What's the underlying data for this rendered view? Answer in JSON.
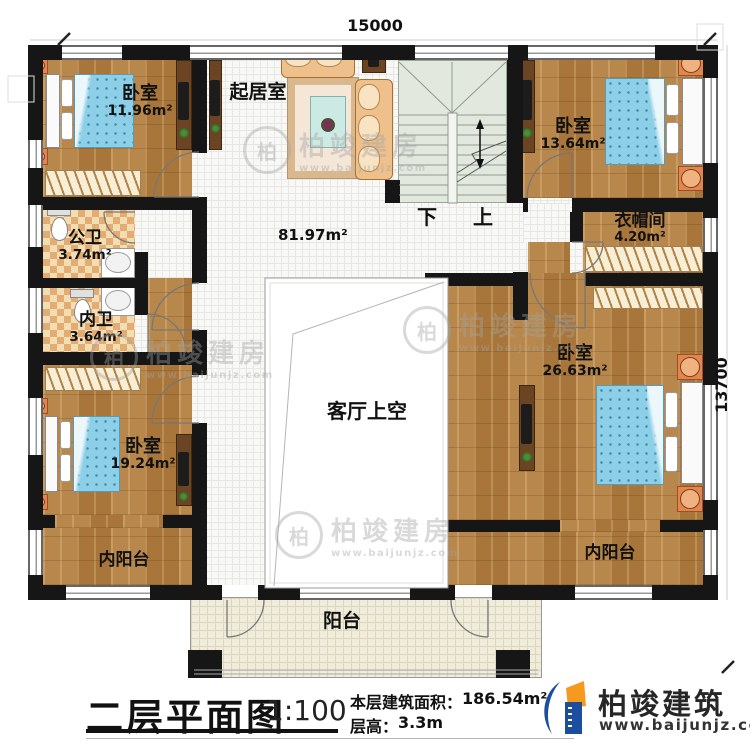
{
  "dimensions": {
    "top": "15000",
    "right": "13700"
  },
  "stairs": {
    "down": "下",
    "up": "上"
  },
  "rooms": {
    "bedroom_tl": {
      "name": "卧室",
      "area": "11.96m²"
    },
    "living": {
      "name": "起居室",
      "area": "81.97m²"
    },
    "bedroom_tr": {
      "name": "卧室",
      "area": "13.64m²"
    },
    "closet": {
      "name": "衣帽间",
      "area": "4.20m²"
    },
    "bath_public": {
      "name": "公卫",
      "area": "3.74m²"
    },
    "bath_private": {
      "name": "内卫",
      "area": "3.64m²"
    },
    "bedroom_bl": {
      "name": "卧室",
      "area": "19.24m²"
    },
    "bedroom_br": {
      "name": "卧室",
      "area": "26.63m²"
    },
    "void": {
      "name": "客厅上空"
    },
    "balcony_inner_left": {
      "name": "内阳台"
    },
    "balcony_inner_right": {
      "name": "内阳台"
    },
    "balcony": {
      "name": "阳台"
    }
  },
  "titleblock": {
    "title": "二层平面图",
    "scale": "1:100",
    "area_label": "本层建筑面积：",
    "area_value": "186.54m²",
    "height_label": "层高：",
    "height_value": "3.3m"
  },
  "logo": {
    "name": "柏竣建筑",
    "url": "www.baijunjz.com"
  },
  "watermark": {
    "symbol": "柏",
    "name": "柏竣建房",
    "url": "www.baijunjz.com"
  }
}
